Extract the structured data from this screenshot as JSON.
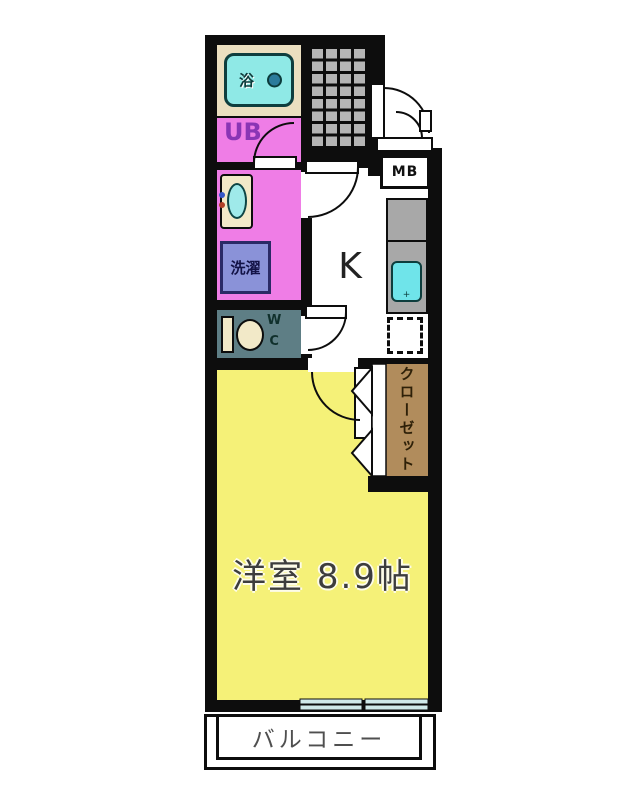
{
  "plan": {
    "type": "apartment-floor-plan",
    "rooms": {
      "bath": {
        "label": "浴"
      },
      "unit_bath": {
        "label": "UB"
      },
      "laundry": {
        "label": "洗濯"
      },
      "wc": {
        "label_line1": "W",
        "label_line2": "C"
      },
      "kitchen": {
        "label": "K"
      },
      "meter_box": {
        "label": "MB"
      },
      "closet": {
        "label": "クローゼット"
      },
      "main_room": {
        "label": "洋室 8.9帖"
      },
      "balcony": {
        "label": "バルコニー"
      }
    },
    "colors": {
      "wall": "#0d0d0d",
      "bath_bg": "#EBDFC0",
      "bathtub": "#8FE9E6",
      "pink_rooms": "#EF7DE6",
      "wc_bg": "#5E7E85",
      "laundry_box": "#8A92D8",
      "main_room_yellow": "#F5F178",
      "closet_brown": "#B18C5C",
      "entrance_tile_gray": "#B5B5B5",
      "counter_gray": "#A8A8A8",
      "kitchen_sink": "#6FE4EA",
      "window_glass": "#CFE9E9",
      "fixture_cream": "#F2E9C8"
    }
  }
}
